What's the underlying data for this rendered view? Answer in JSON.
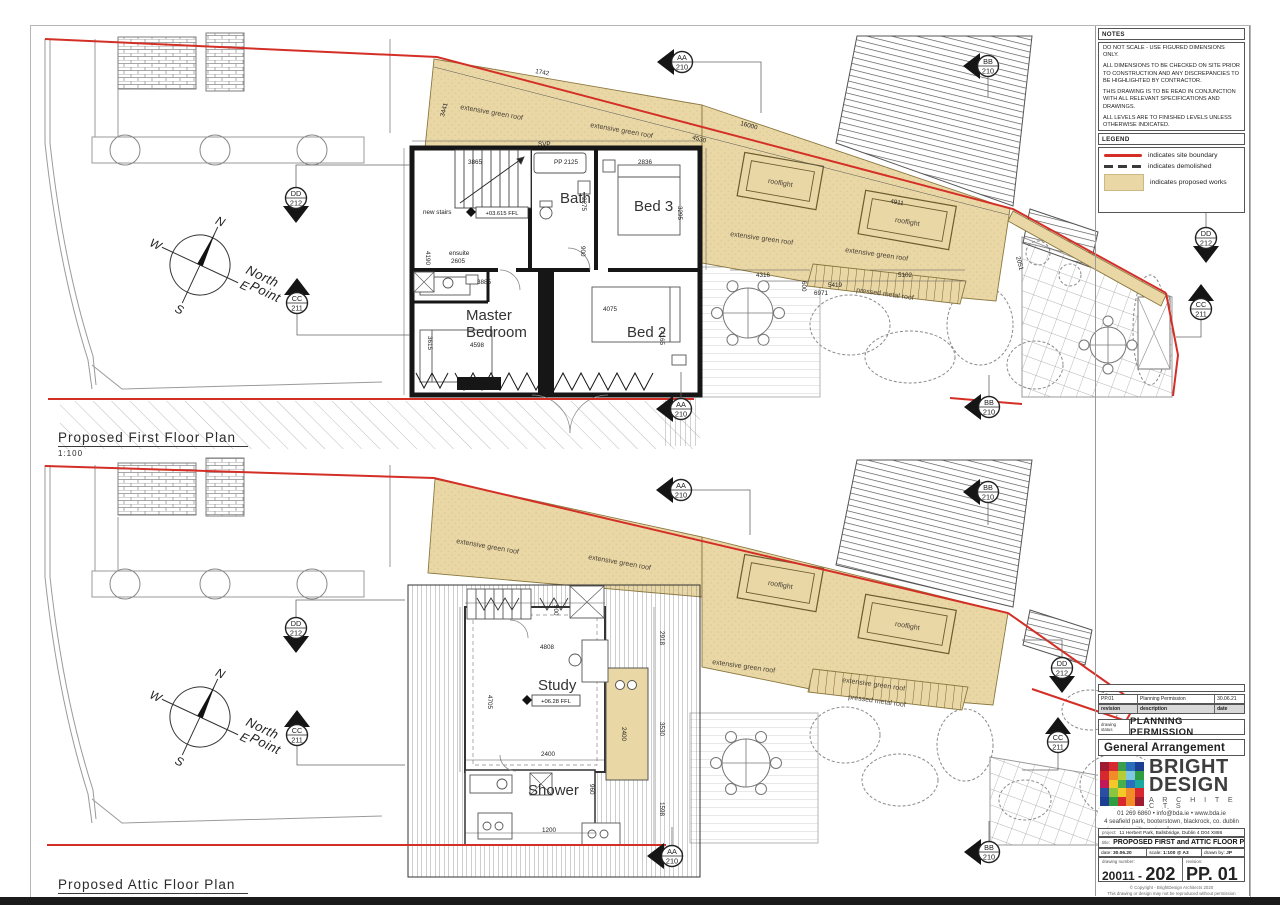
{
  "plans": {
    "first": {
      "title": "Proposed First Floor Plan",
      "scale": "1:100"
    },
    "attic": {
      "title": "Proposed Attic Floor Plan",
      "scale": "1:100"
    }
  },
  "notes": {
    "title": "NOTES",
    "paras": [
      "DO NOT SCALE - USE FIGURED DIMENSIONS ONLY.",
      "ALL DIMENSIONS TO BE CHECKED ON SITE PRIOR TO CONSTRUCTION AND ANY DISCREPANCIES TO BE HIGHLIGHTED BY CONTRACTOR.",
      "THIS DRAWING IS TO BE READ IN CONJUNCTION WITH ALL RELEVANT SPECIFICATIONS AND DRAWINGS.",
      "ALL LEVELS ARE TO FINISHED LEVELS UNLESS OTHERWISE INDICATED.",
      "SUBJECT TO DETAILED DESIGN REVISIONS AND PLANNING CONDITIONS NOT KNOWN AT SCHEME DESIGN STAGE.",
      "TENDER DRAWINGS ARE NOT FOR CONSTRUCTION. ALL SETTING OUT AND DIMENSIONS TO BE AGREED ON SITE BASED ON CONSTRUCTION DRAWINGS."
    ]
  },
  "legend": {
    "title": "LEGEND",
    "items": [
      {
        "label": "indicates site boundary"
      },
      {
        "label": "indicates demolished"
      },
      {
        "label": "indicates proposed works"
      }
    ]
  },
  "colors": {
    "site_boundary": "#d42f26",
    "proposed_works": "#ead7a6",
    "demolished": "#333333"
  },
  "markers": {
    "aa": {
      "code": "AA",
      "num": "210"
    },
    "bb": {
      "code": "BB",
      "num": "210"
    },
    "cc": {
      "code": "CC",
      "num": "211"
    },
    "dd": {
      "code": "DD",
      "num": "212"
    }
  },
  "shared": {
    "n": "N",
    "s": "S",
    "e": "E",
    "w": "W",
    "north1": "North",
    "north2": "Point"
  },
  "f": {
    "newstairs": "new stairs",
    "svp": "SVP",
    "pp2125": "PP 2125",
    "d3865": "3865",
    "d2836": "2836",
    "d2275": "2275",
    "d3295": "3295",
    "d900": "900",
    "ffl": "+03.615 FFL",
    "ensuite": "ensuite",
    "d2605": "2605",
    "d3885": "3885",
    "master1": "Master",
    "master2": "Bedroom",
    "d4598": "4598",
    "bed2": "Bed 2",
    "d4075": "4075",
    "d4165": "4165",
    "d3615": "3615",
    "d4190": "4190",
    "bath": "Bath",
    "bed3": "Bed 3",
    "d3441": "3441",
    "d1742": "1742",
    "d16000": "16000",
    "d4530": "4530",
    "groof": "extensive green roof",
    "rooflight": "rooflight",
    "d4911": "4911",
    "pmr": "pressed metal roof",
    "d4316": "4316",
    "d5419": "5419",
    "d5102": "5102",
    "d600": "600",
    "d6971": "6971",
    "d2051": "2051"
  },
  "a": {
    "study": "Study",
    "ffl": "+06.28 FFL",
    "shower": "Shower",
    "d4808": "4808",
    "d4705": "4705",
    "d2400": "2400",
    "d1200": "1200",
    "d960": "960",
    "d900": "900",
    "d3530": "3530",
    "d2918": "2918",
    "d1598": "1598",
    "groof": "extensive green roof",
    "rooflight": "rooflight",
    "pmr": "pressed metal roof"
  },
  "revision_table": {
    "r1": [
      "PP.01",
      "Planning Permission",
      "30.06.21"
    ],
    "hdr": [
      "revision",
      "description",
      "date"
    ]
  },
  "status": {
    "label1": "drawing",
    "label2": "status",
    "value": "PLANNING PERMISSION"
  },
  "ga": "General Arrangement",
  "firm": {
    "line1": "BRIGHT",
    "line2": "DESIGN",
    "line3": "A R C H I T E C T S",
    "contact": "01 269 6860  •  info@bda.ie  •  www.bda.ie",
    "address": "4 seafield park, booterstown, blackrock, co. dublin",
    "logo_colors": [
      "#9e1b32",
      "#d7282f",
      "#3a9e4e",
      "#2a6fbb",
      "#1c3f94",
      "#d7282f",
      "#f28c28",
      "#b5cc34",
      "#7ec8e3",
      "#2f9e41",
      "#c2185b",
      "#f2c928",
      "#46b04a",
      "#2a6fbb",
      "#1ba8a0",
      "#2a4fa2",
      "#8cc63f",
      "#f2c928",
      "#f28c28",
      "#d7282f",
      "#1c3f94",
      "#2f9e41",
      "#d7282f",
      "#f28c28",
      "#9e1b32"
    ]
  },
  "tb": {
    "project_label": "project:",
    "project": "11 Herbert Park, Ballsbridge, Dublin 4 D04 X886",
    "title_label": "title:",
    "title": "PROPOSED FIRST and ATTIC FLOOR PLANS",
    "date_label": "date:",
    "date": "30.06.20",
    "scale_label": "scale:",
    "scale": "1:100 @ A3",
    "drawn_label": "drawn by:",
    "drawn": "JP",
    "num_label": "drawing number:",
    "num1": "20011 - ",
    "num2": "202",
    "rev_label": "revision:",
    "rev": "PP. 01",
    "copy1": "© Copyright - BrightDesign Architects 2020",
    "copy2": "This drawing or design may not be reproduced without permission"
  }
}
